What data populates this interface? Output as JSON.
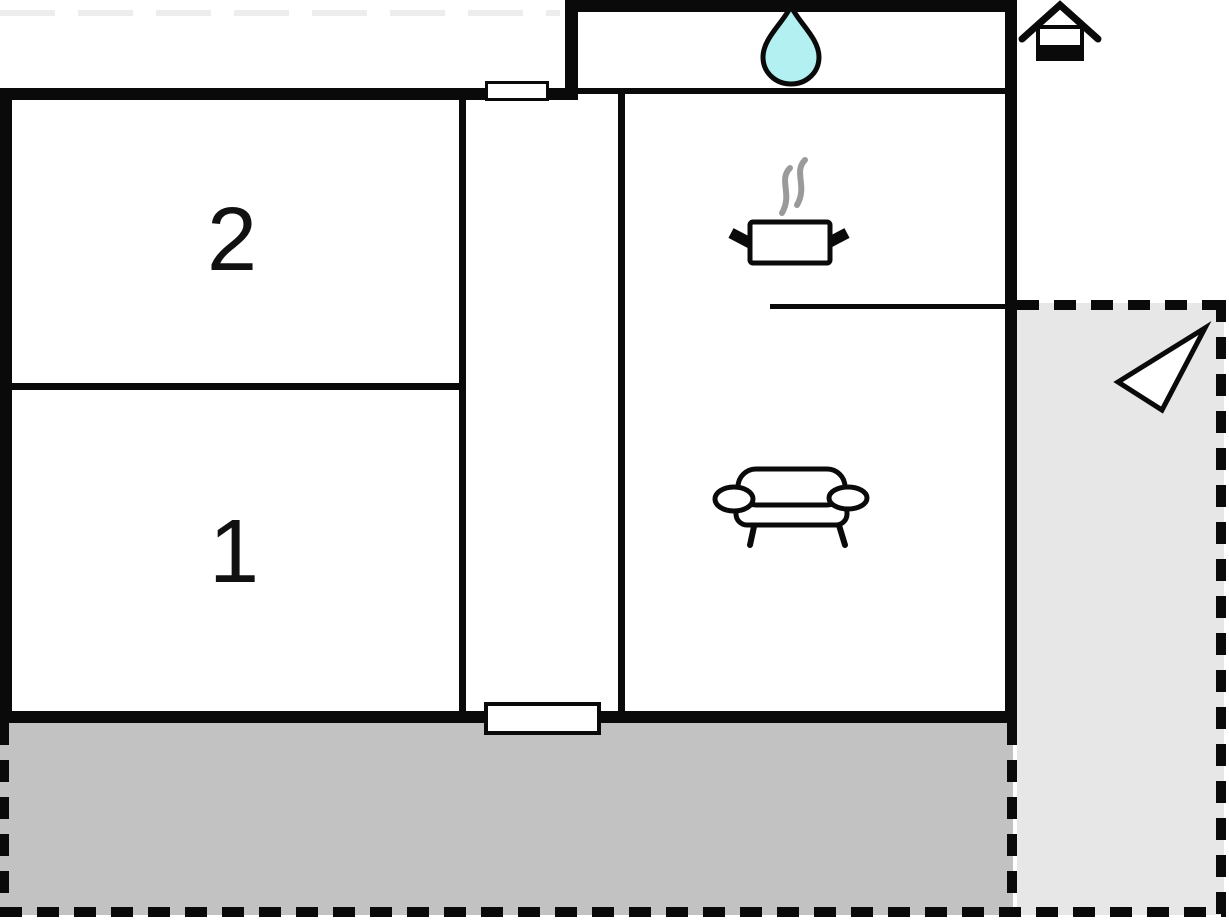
{
  "plan": {
    "type": "floor-plan",
    "room_labels": {
      "room2": "2",
      "room1": "1"
    },
    "icons": [
      "water-drop-icon",
      "stove-icon",
      "sofa-icon",
      "house-icon",
      "direction-arrow-icon"
    ],
    "colors": {
      "wall": "#0a0a0a",
      "terrace_fill": "#c2c2c2",
      "patio_fill": "#e7e7e7",
      "water_drop": "#b2f0f2",
      "steam": "#9a9a9a",
      "faint_boundary": "#ededed",
      "background": "#ffffff"
    }
  }
}
